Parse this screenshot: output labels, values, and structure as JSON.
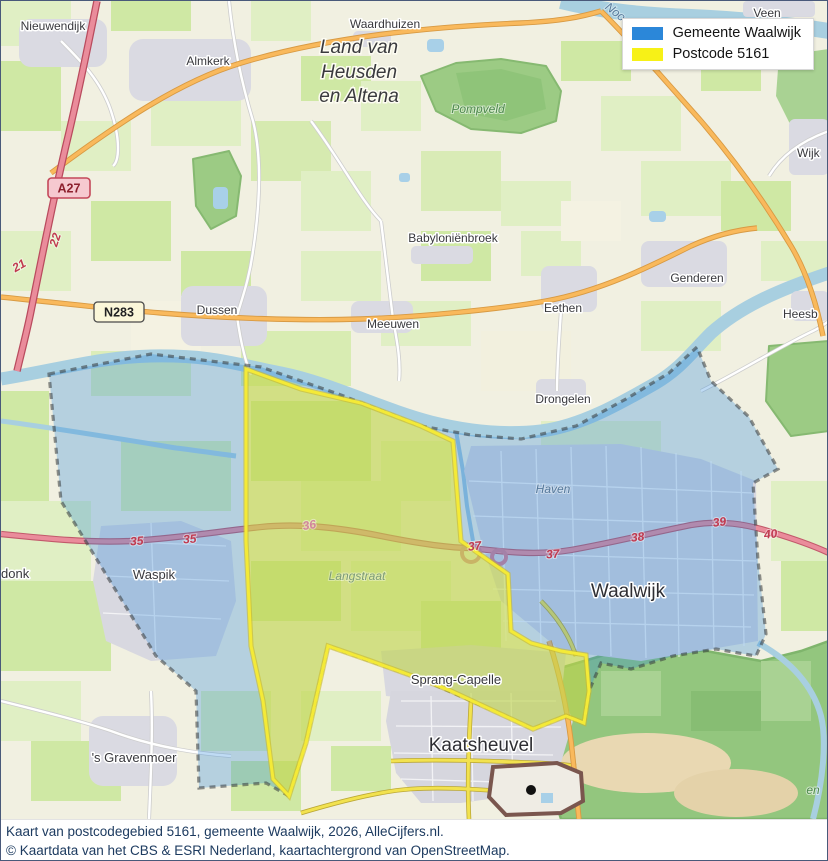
{
  "legend": {
    "items": [
      {
        "label": "Gemeente Waalwijk",
        "color": "#2b87d9"
      },
      {
        "label": "Postcode 5161",
        "color": "#f7f117"
      }
    ]
  },
  "caption": {
    "line1": "Kaart van postcodegebied 5161, gemeente Waalwijk, 2026, AlleCijfers.nl.",
    "line2": "© Kaartdata van het CBS & ESRI Nederland, kaartachtergrond van OpenStreetMap."
  },
  "map": {
    "towns": {
      "nieuwendijk": "Nieuwendijk",
      "almkerk": "Almkerk",
      "waardhuizen": "Waardhuizen",
      "babylonienbroek": "Babyloniënbroek",
      "genderen": "Genderen",
      "dussen": "Dussen",
      "meeuwen": "Meeuwen",
      "eethen": "Eethen",
      "heesbeen": "Heesb",
      "drongelen": "Drongelen",
      "wijk": "Wijk",
      "veen": "Veen",
      "waspik": "Waspik",
      "waalwijk": "Waalwijk",
      "donk": "donk",
      "sprang_capelle": "Sprang-Capelle",
      "kaatsheuvel": "Kaatsheuvel",
      "gravenmoer": "'s Gravenmoer"
    },
    "region_label": {
      "line1": "Land van",
      "line2": "Heusden",
      "line3": "en Altena"
    },
    "areas": {
      "pompveld": "Pompveld",
      "langstraat": "Langstraat",
      "haven": "Haven",
      "noo": "Noo",
      "en": "en"
    },
    "exits": {
      "n21": "21",
      "n22": "22",
      "n35": "35",
      "n36": "36",
      "n37": "37",
      "n38": "38",
      "n39": "39",
      "n40": "40"
    },
    "shields": {
      "a27": "A27",
      "n283": "N283"
    }
  }
}
